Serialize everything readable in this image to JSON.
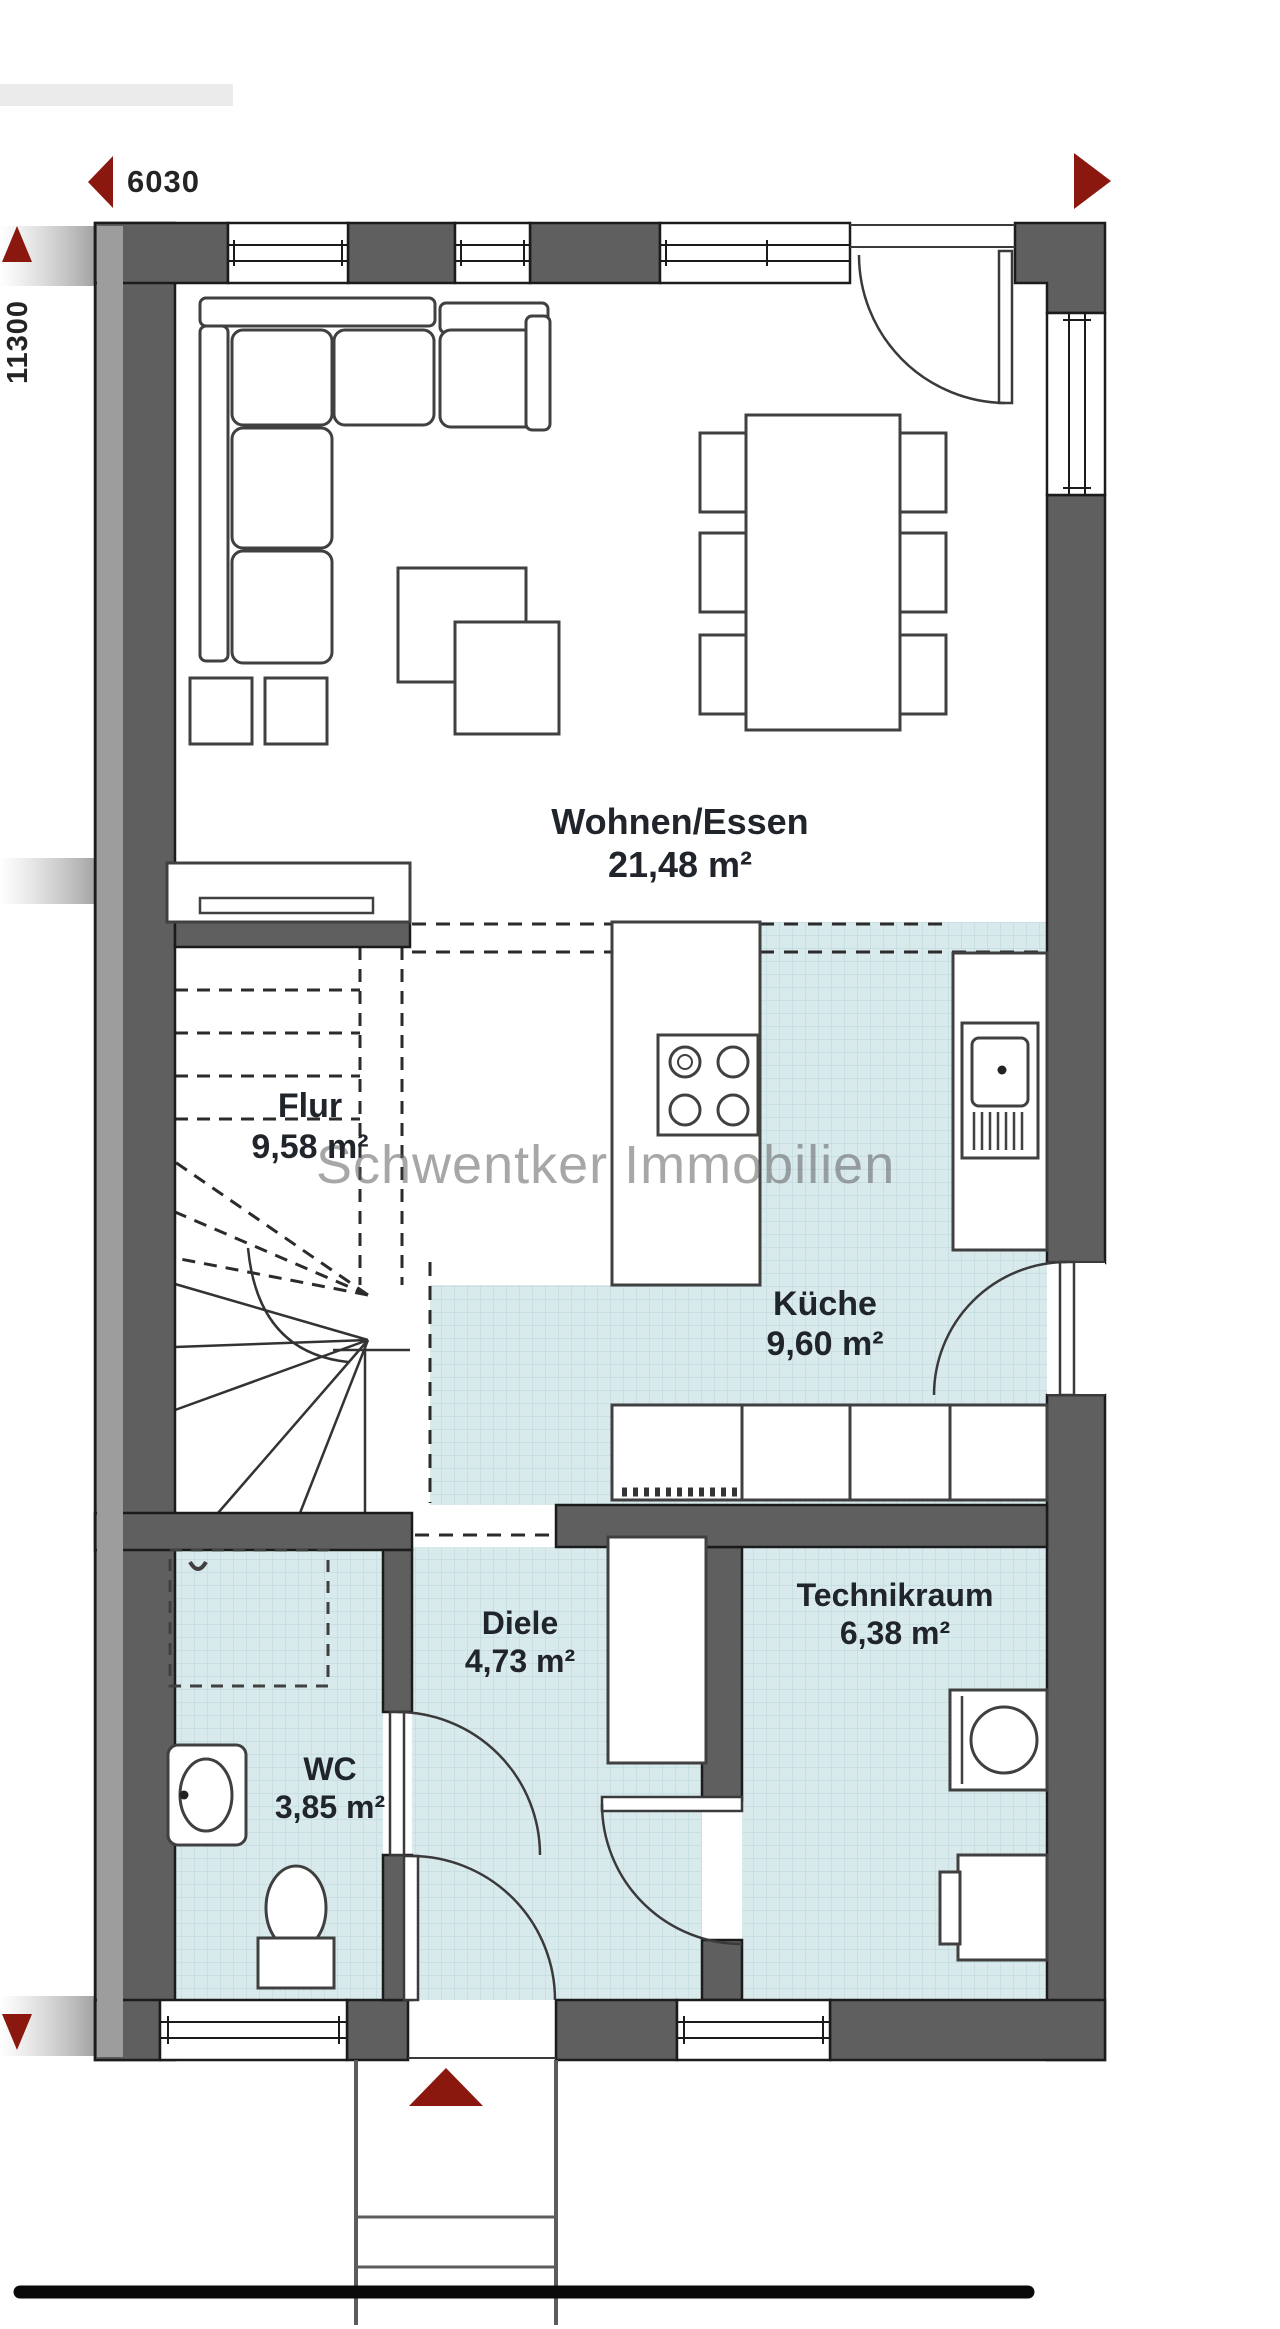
{
  "plan": {
    "watermark": "Schwentker Immobilien",
    "dimensions": {
      "width_label": "6030",
      "height_label": "11300"
    },
    "rooms": [
      {
        "id": "wohnen",
        "name": "Wohnen/Essen",
        "area": "21,48 m²"
      },
      {
        "id": "flur",
        "name": "Flur",
        "area": "9,58 m²"
      },
      {
        "id": "kueche",
        "name": "Küche",
        "area": "9,60 m²"
      },
      {
        "id": "diele",
        "name": "Diele",
        "area": "4,73 m²"
      },
      {
        "id": "technikraum",
        "name": "Technikraum",
        "area": "6,38 m²"
      },
      {
        "id": "wc",
        "name": "WC",
        "area": "3,85 m²"
      }
    ],
    "colors": {
      "wall": "#5f5f5f",
      "tile": "#d9eaed",
      "accent_red": "#8a180f"
    }
  }
}
